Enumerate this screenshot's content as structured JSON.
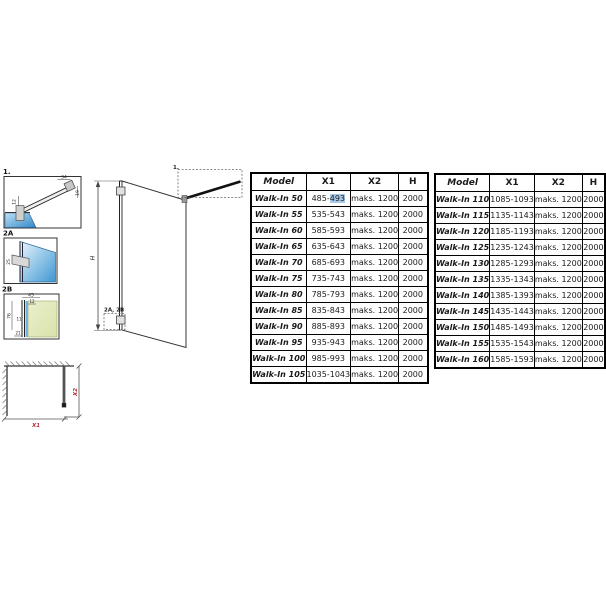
{
  "drawing": {
    "details": {
      "d1": {
        "label": "1.",
        "dim_top": "34",
        "dim_right": "19",
        "dim_left": "12"
      },
      "d2a": {
        "label": "2A",
        "dim": "25"
      },
      "d2b": {
        "label": "2B",
        "dim_top": "45",
        "dim_top2": "12",
        "dim_left": "76",
        "dim_mid": "11",
        "dim_bottom": "21"
      }
    },
    "elevation": {
      "height_label": "H",
      "detail_ref": "1.",
      "bracket_ref": "2A, 2B"
    },
    "plan": {
      "dim_x1": "X1",
      "dim_x2": "X2"
    }
  },
  "tables": {
    "left": {
      "headers": [
        "Model",
        "X1",
        "X2",
        "H"
      ],
      "rows": [
        [
          "Walk-In 50",
          "485-493",
          "maks. 1200",
          "2000"
        ],
        [
          "Walk-In 55",
          "535-543",
          "maks. 1200",
          "2000"
        ],
        [
          "Walk-In 60",
          "585-593",
          "maks. 1200",
          "2000"
        ],
        [
          "Walk-In 65",
          "635-643",
          "maks. 1200",
          "2000"
        ],
        [
          "Walk-In 70",
          "685-693",
          "maks. 1200",
          "2000"
        ],
        [
          "Walk-In 75",
          "735-743",
          "maks. 1200",
          "2000"
        ],
        [
          "Walk-In 80",
          "785-793",
          "maks. 1200",
          "2000"
        ],
        [
          "Walk-In 85",
          "835-843",
          "maks. 1200",
          "2000"
        ],
        [
          "Walk-In 90",
          "885-893",
          "maks. 1200",
          "2000"
        ],
        [
          "Walk-In 95",
          "935-943",
          "maks. 1200",
          "2000"
        ],
        [
          "Walk-In 100",
          "985-993",
          "maks. 1200",
          "2000"
        ],
        [
          "Walk-In 105",
          "1035-1043",
          "maks. 1200",
          "2000"
        ]
      ],
      "selection": {
        "row": 0,
        "col": 1,
        "text": "493"
      }
    },
    "right": {
      "headers": [
        "Model",
        "X1",
        "X2",
        "H"
      ],
      "rows": [
        [
          "Walk-In 110",
          "1085-1093",
          "maks. 1200",
          "2000"
        ],
        [
          "Walk-In 115",
          "1135-1143",
          "maks. 1200",
          "2000"
        ],
        [
          "Walk-In 120",
          "1185-1193",
          "maks. 1200",
          "2000"
        ],
        [
          "Walk-In 125",
          "1235-1243",
          "maks. 1200",
          "2000"
        ],
        [
          "Walk-In 130",
          "1285-1293",
          "maks. 1200",
          "2000"
        ],
        [
          "Walk-In 135",
          "1335-1343",
          "maks. 1200",
          "2000"
        ],
        [
          "Walk-In 140",
          "1385-1393",
          "maks. 1200",
          "2000"
        ],
        [
          "Walk-In 145",
          "1435-1443",
          "maks. 1200",
          "2000"
        ],
        [
          "Walk-In 150",
          "1485-1493",
          "maks. 1200",
          "2000"
        ],
        [
          "Walk-In 155",
          "1535-1543",
          "maks. 1200",
          "2000"
        ],
        [
          "Walk-In 160",
          "1585-1593",
          "maks. 1200",
          "2000"
        ]
      ]
    }
  },
  "colors": {
    "accent_red": "#b5313c",
    "selection_highlight": "#a9c9e8",
    "glass_blue": "#4aa0d8",
    "glass_blue_light": "#d6edfa",
    "glass_green": "#e2eac0",
    "line": "#222222"
  }
}
